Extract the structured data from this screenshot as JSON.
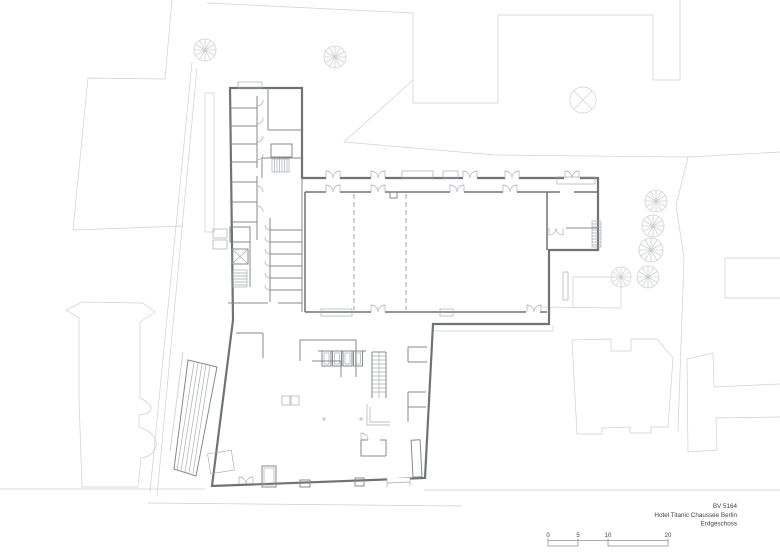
{
  "document": {
    "kind": "Architectural site and ground floor plan drawing"
  },
  "title_block": {
    "project_id": "BV 5164",
    "project_name": "Hotel Titanic Chaussee Berlin",
    "level": "Erdgeschoss"
  },
  "scale_bar": {
    "labels": [
      "0",
      "5",
      "10",
      "20"
    ],
    "values_m": [
      0,
      5,
      10,
      20
    ]
  },
  "site": {
    "trees": [
      {
        "x": 205,
        "y": 50,
        "r": 11
      },
      {
        "x": 335,
        "y": 57,
        "r": 11
      },
      {
        "x": 656,
        "y": 201,
        "r": 11
      },
      {
        "x": 653,
        "y": 226,
        "r": 11
      },
      {
        "x": 651,
        "y": 250,
        "r": 12
      },
      {
        "x": 648,
        "y": 277,
        "r": 11
      },
      {
        "x": 621,
        "y": 277,
        "r": 10
      }
    ],
    "marked_tree": {
      "x": 583,
      "y": 100,
      "r": 13
    }
  },
  "colors": {
    "background": "#ffffff",
    "site_line": "#cdd0d2",
    "wall": "#6f7376",
    "partition": "#868a8d",
    "detail": "#a4a8ab",
    "text_col": "#3f3f3f"
  }
}
